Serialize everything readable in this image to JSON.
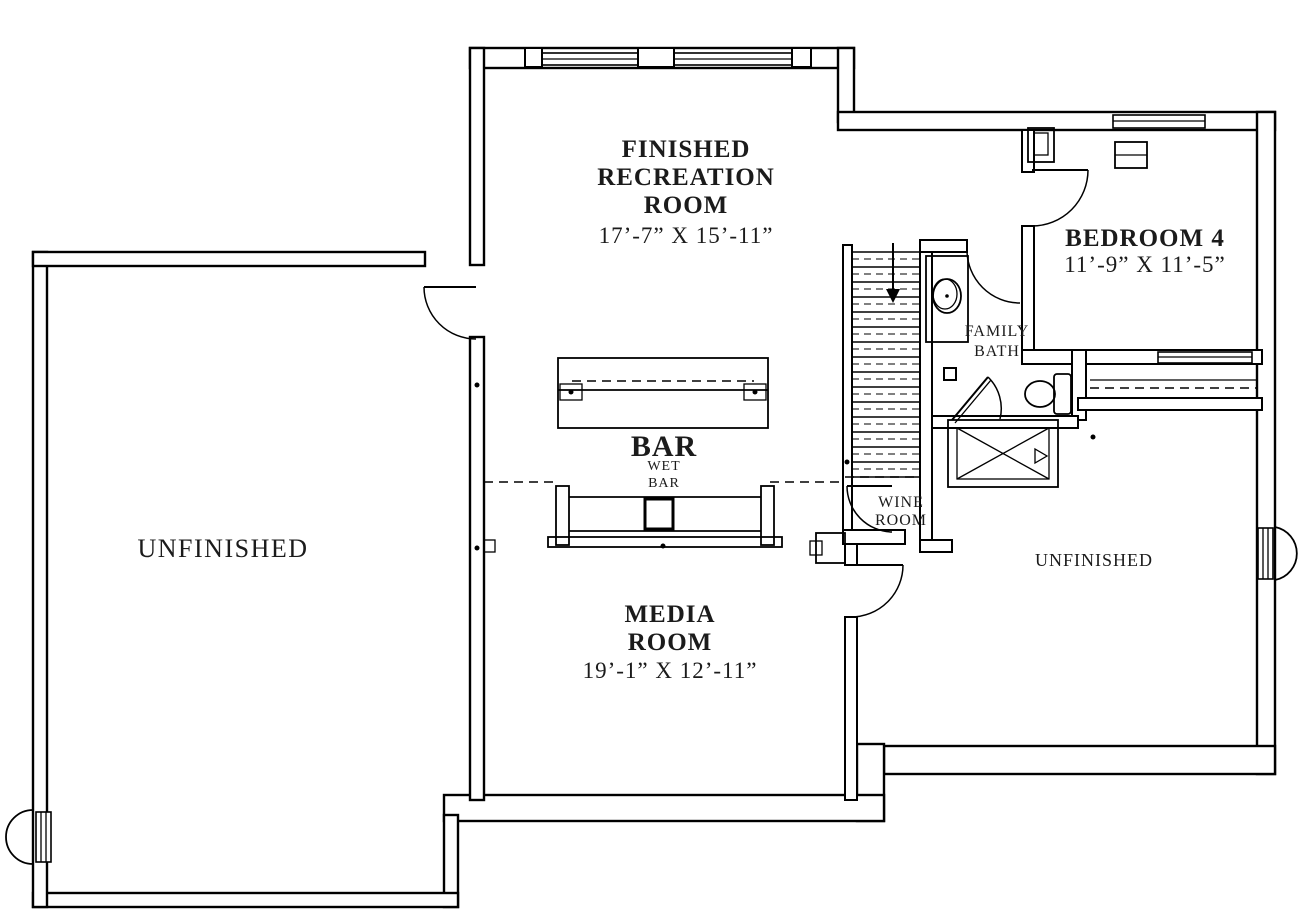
{
  "colors": {
    "walls": "#000000",
    "background": "#ffffff",
    "text": "#1b1b1b"
  },
  "rooms": {
    "recreation": {
      "line1": "FINISHED",
      "line2": "RECREATION",
      "line3": "ROOM",
      "dims": "17’-7” X 15’-11”"
    },
    "bedroom4": {
      "name": "BEDROOM 4",
      "dims": "11’-9” X 11’-5”"
    },
    "family_bath": {
      "line1": "FAMILY",
      "line2": "BATH"
    },
    "wet_bar": {
      "title": "BAR",
      "sub1": "WET",
      "sub2": "BAR"
    },
    "wine_room": {
      "line1": "WINE",
      "line2": "ROOM"
    },
    "media": {
      "line1": "MEDIA",
      "line2": "ROOM",
      "dims": "19’-1” X 12’-11”"
    },
    "unfinished_left": {
      "name": "UNFINISHED"
    },
    "unfinished_right": {
      "name": "UNFINISHED"
    }
  }
}
